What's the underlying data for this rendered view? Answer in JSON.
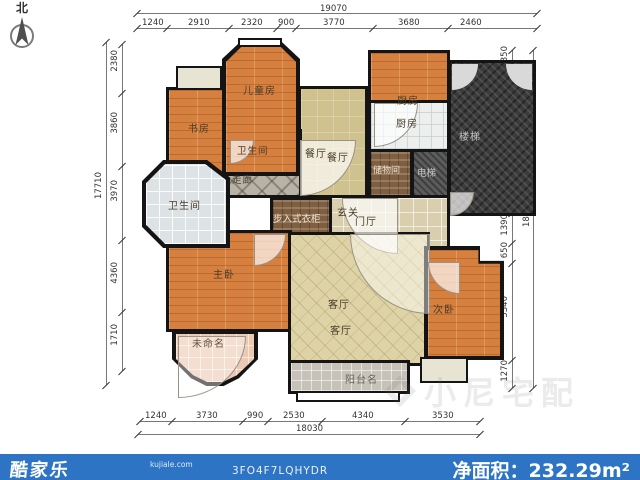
{
  "compass": {
    "label": "北"
  },
  "watermark": {
    "text": "小尼宅配"
  },
  "footer": {
    "logo": "酷家乐",
    "domain": "kujiale.com",
    "code": "3FO4F7LQHYDR",
    "net_area": "净面积：232.29m²",
    "bar_color": "#2e74c4"
  },
  "rooms": {
    "children": "儿童房",
    "study": "书房",
    "bath_small": "卫生间",
    "corridor": "走廊",
    "dining_a": "餐厅",
    "dining_b": "餐厅",
    "kitchen_a": "厨房",
    "kitchen_b": "厨房",
    "stairs": "楼梯",
    "storage": "储物间",
    "elevator": "电梯",
    "entry": "玄关",
    "foyer": "门厅",
    "closet": "步入式衣柜",
    "bath_large": "卫生间",
    "master": "主卧",
    "unnamed": "未命名",
    "living_a": "客厅",
    "living_b": "客厅",
    "second": "次卧",
    "balcony": "阳台名"
  },
  "dimensions": {
    "top": {
      "total": "19070",
      "segments": [
        "1240",
        "2910",
        "2320",
        "900",
        "3770",
        "3680",
        "2460"
      ]
    },
    "bottom": {
      "total": "18030",
      "segments": [
        "1240",
        "3730",
        "990",
        "2530",
        "4340",
        "3530"
      ]
    },
    "left": {
      "total": "17710",
      "segments": [
        "2380",
        "3860",
        "3970",
        "4360",
        "1710"
      ]
    },
    "right": {
      "total": "18220",
      "segments": [
        "350",
        "7490",
        "1390",
        "650",
        "5340",
        "1270"
      ]
    }
  }
}
